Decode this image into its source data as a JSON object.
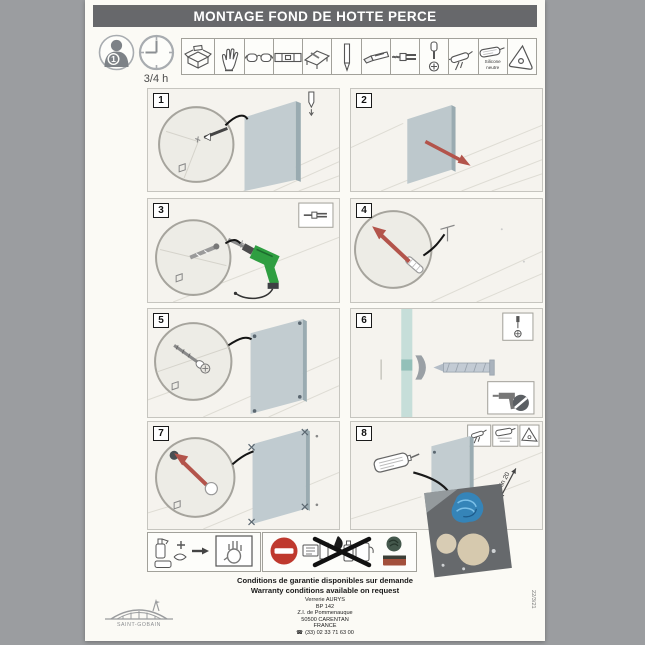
{
  "header": {
    "title": "MONTAGE FOND DE HOTTE PERCE",
    "persons": "1",
    "duration": "3/4 h"
  },
  "tools": {
    "icon_names": [
      "packaging-contents",
      "protective-glove",
      "safety-glasses",
      "spirit-level",
      "set-square",
      "pencil",
      "cutter-knife",
      "drill-bit-and-anchor",
      "screwdriver-and-screw",
      "caulking-gun",
      "silicone-cartridge",
      "plastic-smoother"
    ],
    "silicone_label_line1": "Silicone",
    "silicone_label_line2": "neutre"
  },
  "steps": [
    {
      "number": "1"
    },
    {
      "number": "2"
    },
    {
      "number": "3"
    },
    {
      "number": "4"
    },
    {
      "number": "5"
    },
    {
      "number": "6"
    },
    {
      "number": "7"
    },
    {
      "number": "8",
      "annotation": "min 20"
    }
  ],
  "footer": {
    "warranty_fr": "Conditions de garantie disponibles sur demande",
    "warranty_en": "Warranty conditions available on request",
    "company": "Verrerie AURYS",
    "address_bp": "BP 142",
    "address_zi": "Z.I. de Pommenauque",
    "address_city": "50500 CARENTAN",
    "address_country": "FRANCE",
    "phone": "(33) 02 33 71 63 00",
    "phone_icon": "☎",
    "logo_text": "SAINT-GOBAIN",
    "date_code": "22/3/21"
  },
  "colors": {
    "accent_red": "#b3544b",
    "drill_green": "#2f9e41",
    "prohibition_red": "#bf392e",
    "glove_blue": "#3584b8",
    "glass_blue_gray": "#c2ccd0",
    "title_bar_gray": "#67686b"
  }
}
